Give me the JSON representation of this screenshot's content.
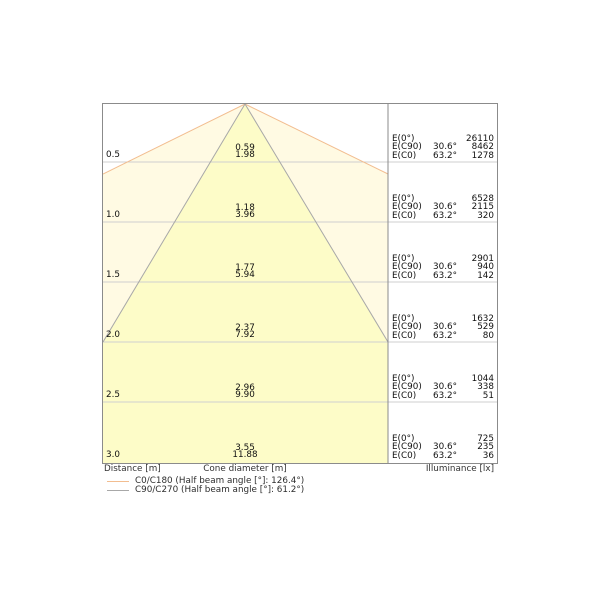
{
  "axes": {
    "distance_label": "Distance [m]",
    "cone_diameter_label": "Cone diameter [m]",
    "illuminance_label": "Illuminance [lx]"
  },
  "legend": {
    "items": [
      {
        "label": "C0/C180 (Half beam angle [°]: 126.4°)",
        "color": "#f2bd90"
      },
      {
        "label": "C90/C270 (Half beam angle [°]: 61.2°)",
        "color": "#a8a8a8"
      }
    ]
  },
  "colors": {
    "outer_cone_fill": "#fffae3",
    "inner_cone_fill": "#fdfcc8",
    "c0_line": "#f2bd90",
    "c90_line": "#a8a8a8",
    "grid_line": "#cfcfcf",
    "border": "#8b8b8b"
  },
  "rows": [
    {
      "distance": "0.5",
      "cone_c90": "0.59",
      "cone_c0": "1.98",
      "e0_label": "E(0°)",
      "e0_value": "26110",
      "ec90_label": "E(C90)",
      "ec90_angle": "30.6°",
      "ec90_value": "8462",
      "ec0_label": "E(C0)",
      "ec0_angle": "63.2°",
      "ec0_value": "1278"
    },
    {
      "distance": "1.0",
      "cone_c90": "1.18",
      "cone_c0": "3.96",
      "e0_label": "E(0°)",
      "e0_value": "6528",
      "ec90_label": "E(C90)",
      "ec90_angle": "30.6°",
      "ec90_value": "2115",
      "ec0_label": "E(C0)",
      "ec0_angle": "63.2°",
      "ec0_value": "320"
    },
    {
      "distance": "1.5",
      "cone_c90": "1.77",
      "cone_c0": "5.94",
      "e0_label": "E(0°)",
      "e0_value": "2901",
      "ec90_label": "E(C90)",
      "ec90_angle": "30.6°",
      "ec90_value": "940",
      "ec0_label": "E(C0)",
      "ec0_angle": "63.2°",
      "ec0_value": "142"
    },
    {
      "distance": "2.0",
      "cone_c90": "2.37",
      "cone_c0": "7.92",
      "e0_label": "E(0°)",
      "e0_value": "1632",
      "ec90_label": "E(C90)",
      "ec90_angle": "30.6°",
      "ec90_value": "529",
      "ec0_label": "E(C0)",
      "ec0_angle": "63.2°",
      "ec0_value": "80"
    },
    {
      "distance": "2.5",
      "cone_c90": "2.96",
      "cone_c0": "9.90",
      "e0_label": "E(0°)",
      "e0_value": "1044",
      "ec90_label": "E(C90)",
      "ec90_angle": "30.6°",
      "ec90_value": "338",
      "ec0_label": "E(C0)",
      "ec0_angle": "63.2°",
      "ec0_value": "51"
    },
    {
      "distance": "3.0",
      "cone_c90": "3.55",
      "cone_c0": "11.88",
      "e0_label": "E(0°)",
      "e0_value": "725",
      "ec90_label": "E(C90)",
      "ec90_angle": "30.6°",
      "ec90_value": "235",
      "ec0_label": "E(C0)",
      "ec0_angle": "63.2°",
      "ec0_value": "36"
    }
  ],
  "chart_data": {
    "type": "area",
    "subtype": "light-cone-diagram",
    "x": [
      0.5,
      1.0,
      1.5,
      2.0,
      2.5,
      3.0
    ],
    "xlabel": "Distance [m]",
    "series": [
      {
        "name": "C0/C180 (Half beam angle [°]: 126.4°)",
        "half_beam_angle_deg": 126.4,
        "cone_diameter_m": [
          1.98,
          3.96,
          5.94,
          7.92,
          9.9,
          11.88
        ],
        "color": "#f2bd90"
      },
      {
        "name": "C90/C270 (Half beam angle [°]: 61.2°)",
        "half_beam_angle_deg": 61.2,
        "cone_diameter_m": [
          0.59,
          1.18,
          1.77,
          2.37,
          2.96,
          3.55
        ],
        "color": "#a8a8a8"
      }
    ],
    "illuminance_lx": {
      "E(0°)": [
        26110,
        6528,
        2901,
        1632,
        1044,
        725
      ],
      "E(C90) 30.6°": [
        8462,
        2115,
        940,
        529,
        338,
        235
      ],
      "E(C0) 63.2°": [
        1278,
        320,
        142,
        80,
        51,
        36
      ]
    },
    "value_labels": {
      "cone_diameter": "Cone diameter [m]",
      "illuminance": "Illuminance [lx]"
    },
    "legend_position": "bottom-left",
    "grid": true
  }
}
